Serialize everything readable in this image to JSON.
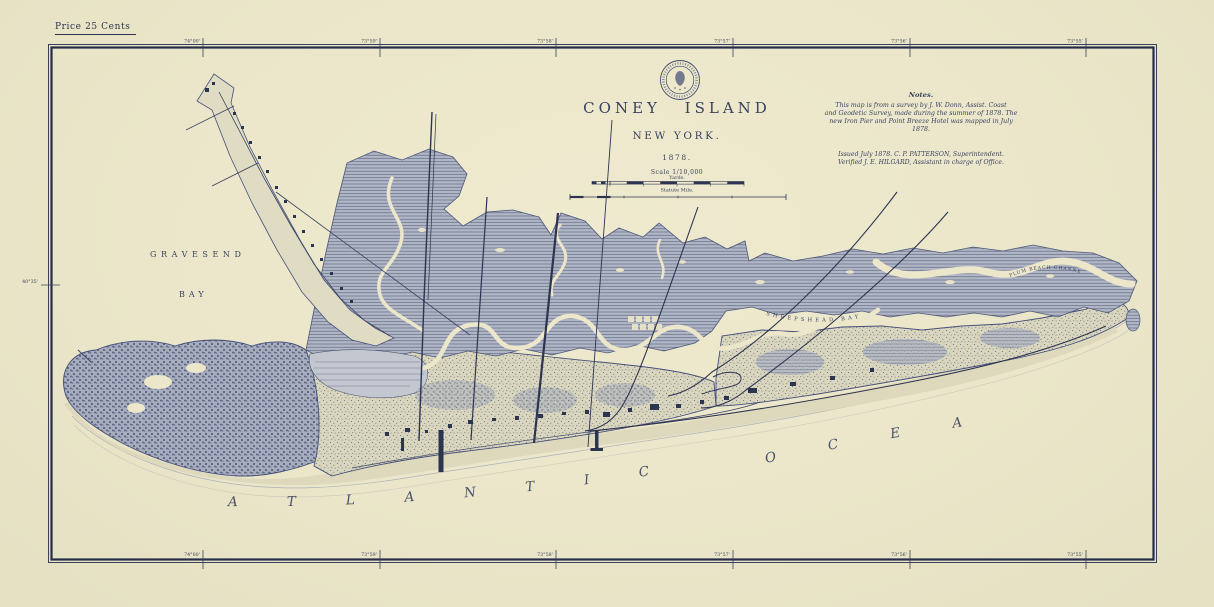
{
  "page": {
    "price_label": "Price 25 Cents"
  },
  "title_block": {
    "title": "CONEY ISLAND",
    "subtitle": "NEW YORK.",
    "year": "1878.",
    "scale_label": "Scale 1/10,000",
    "yards_label": "Yards.",
    "mile_label": "Statute Mile."
  },
  "notes": {
    "heading": "Notes.",
    "line1": "This map is from a survey by J. W. Donn, Assist. Coast",
    "line2": "and Geodetic Survey, made during the summer of 1878. The",
    "line3": "new Iron Pier and Point Breeze Hotel was mapped in July 1878.",
    "issued": "Issued July 1878. C. P. PATTERSON, Superintendent.",
    "verified": "Verified J. E. HILGARD, Assistant in charge of Office."
  },
  "water_labels": {
    "gravesend": "GRAVESEND",
    "bay": "BAY",
    "sheepshead_bay": "SHEEPSHEAD BAY",
    "plum_beach_channel": "PLUM BEACH CHANNEL",
    "atlantic": "ATLANTIC",
    "ocean": "OCEAN"
  },
  "graticule": {
    "top": [
      "74°00'",
      "73°59'",
      "73°58'",
      "73°57'",
      "73°56'",
      "73°55'"
    ],
    "bottom": [
      "74°00'",
      "73°59'",
      "73°58'",
      "73°57'",
      "73°56'",
      "73°55'"
    ],
    "left_latitude": "40°35'"
  },
  "colors": {
    "paper": "#ebe6c9",
    "ink": "#2c3450",
    "map_blue": "#46507a",
    "marsh": "#b2b7c5",
    "sand": "#ded9bc"
  }
}
